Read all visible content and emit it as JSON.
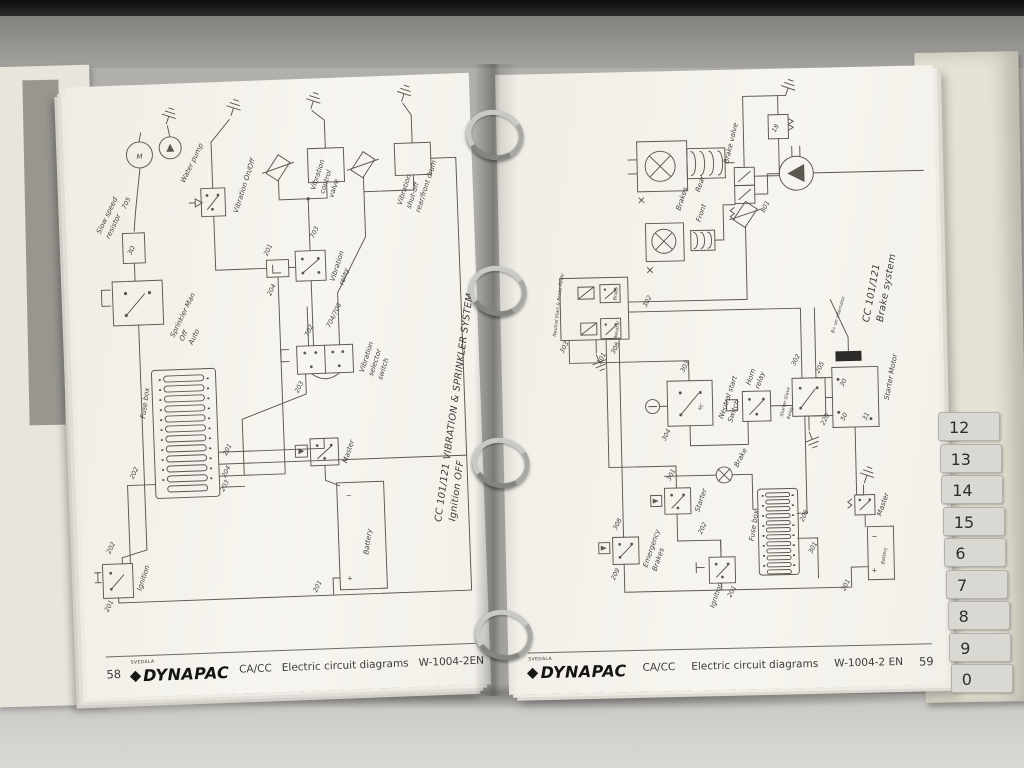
{
  "binder": {
    "tabs": [
      "12",
      "13",
      "14",
      "15",
      "6",
      "7",
      "8",
      "9",
      "0"
    ]
  },
  "left_page": {
    "page_number": "58",
    "footer": {
      "brand_small": "SVEDALA",
      "brand": "DYNAPAC",
      "model": "CA/CC",
      "doc_title": "Electric circuit diagrams",
      "doc_ref": "W-1004-2EN"
    },
    "title1": "CC 101/121 VIBRATION & SPRINKLER SYSTEM",
    "title2": "Ignition OFF",
    "labels": {
      "motor": "M",
      "water_pump": "Water pump",
      "slow_speed_1": "Slow speed",
      "slow_speed_2": "resistor",
      "resistor_value": "3Ω",
      "sprinkler_1": "Sprinkler Man",
      "sprinkler_2": "Off",
      "sprinkler_3": "Auto",
      "vibration_onoff": "Vibration On/Off",
      "vib_control_1": "Vibration",
      "vib_control_2": "control",
      "vib_control_3": "valve",
      "vib_shutoff_1": "Vibration",
      "vib_shutoff_2": "shut-off",
      "vib_shutoff_3": "rear/front drum",
      "vib_relay_1": "Vibration",
      "vib_relay_2": "relay",
      "vib_selector_1": "Vibration",
      "vib_selector_2": "selector",
      "vib_selector_3": "switch",
      "fuse_box": "Fuse box",
      "master": "Master",
      "battery": "Battery",
      "plus": "+",
      "minus": "−",
      "ignition": "Ignition"
    },
    "wires": {
      "w705": "705",
      "w703": "703",
      "w702": "702",
      "w704_706": "704/706",
      "w201": "201",
      "w202": "202",
      "w203": "203",
      "w204": "204"
    }
  },
  "right_page": {
    "page_number": "59",
    "footer": {
      "brand_small": "SVEDALA",
      "brand": "DYNAPAC",
      "model": "CA/CC",
      "doc_title": "Electric circuit diagrams",
      "doc_ref": "W-1004-2 EN"
    },
    "title1": "CC 101/121",
    "title2": "Brake system",
    "labels": {
      "brake_valve": "Brake valve",
      "brakes": "Brakes",
      "rear": "Rear",
      "front": "Front",
      "relief": "18",
      "nsb_relay": "Neutral Start & Brake Relay",
      "brake_relay": "Brake",
      "neutral_relay": "Neutral",
      "horn_relay_1": "Horn",
      "horn_relay_2": "relay",
      "neutral_start_1": "Neutral start",
      "neutral_start_2": "Switch",
      "nc": "NC",
      "b_plus": "B+ on alternator",
      "slave_1": "Starter Slave",
      "slave_2": "Relay",
      "starter_motor": "Starter Motor",
      "t30": "30",
      "t50": "50",
      "t31": "31",
      "brake_lamp": "Brake",
      "starter": "Starter",
      "emergency_1": "Emergency",
      "emergency_2": "Brakes",
      "ignition": "Ignition",
      "fuse_box": "Fuse box",
      "master": "Master",
      "battery": "Battery",
      "plus": "+",
      "minus": "−"
    },
    "wires": {
      "w801": "801",
      "w301": "301",
      "w302": "302",
      "w303": "303",
      "w304": "304",
      "w308": "308",
      "w205": "205",
      "w220": "220",
      "w208": "208",
      "w209": "209",
      "w201": "201",
      "w202": "202"
    }
  }
}
